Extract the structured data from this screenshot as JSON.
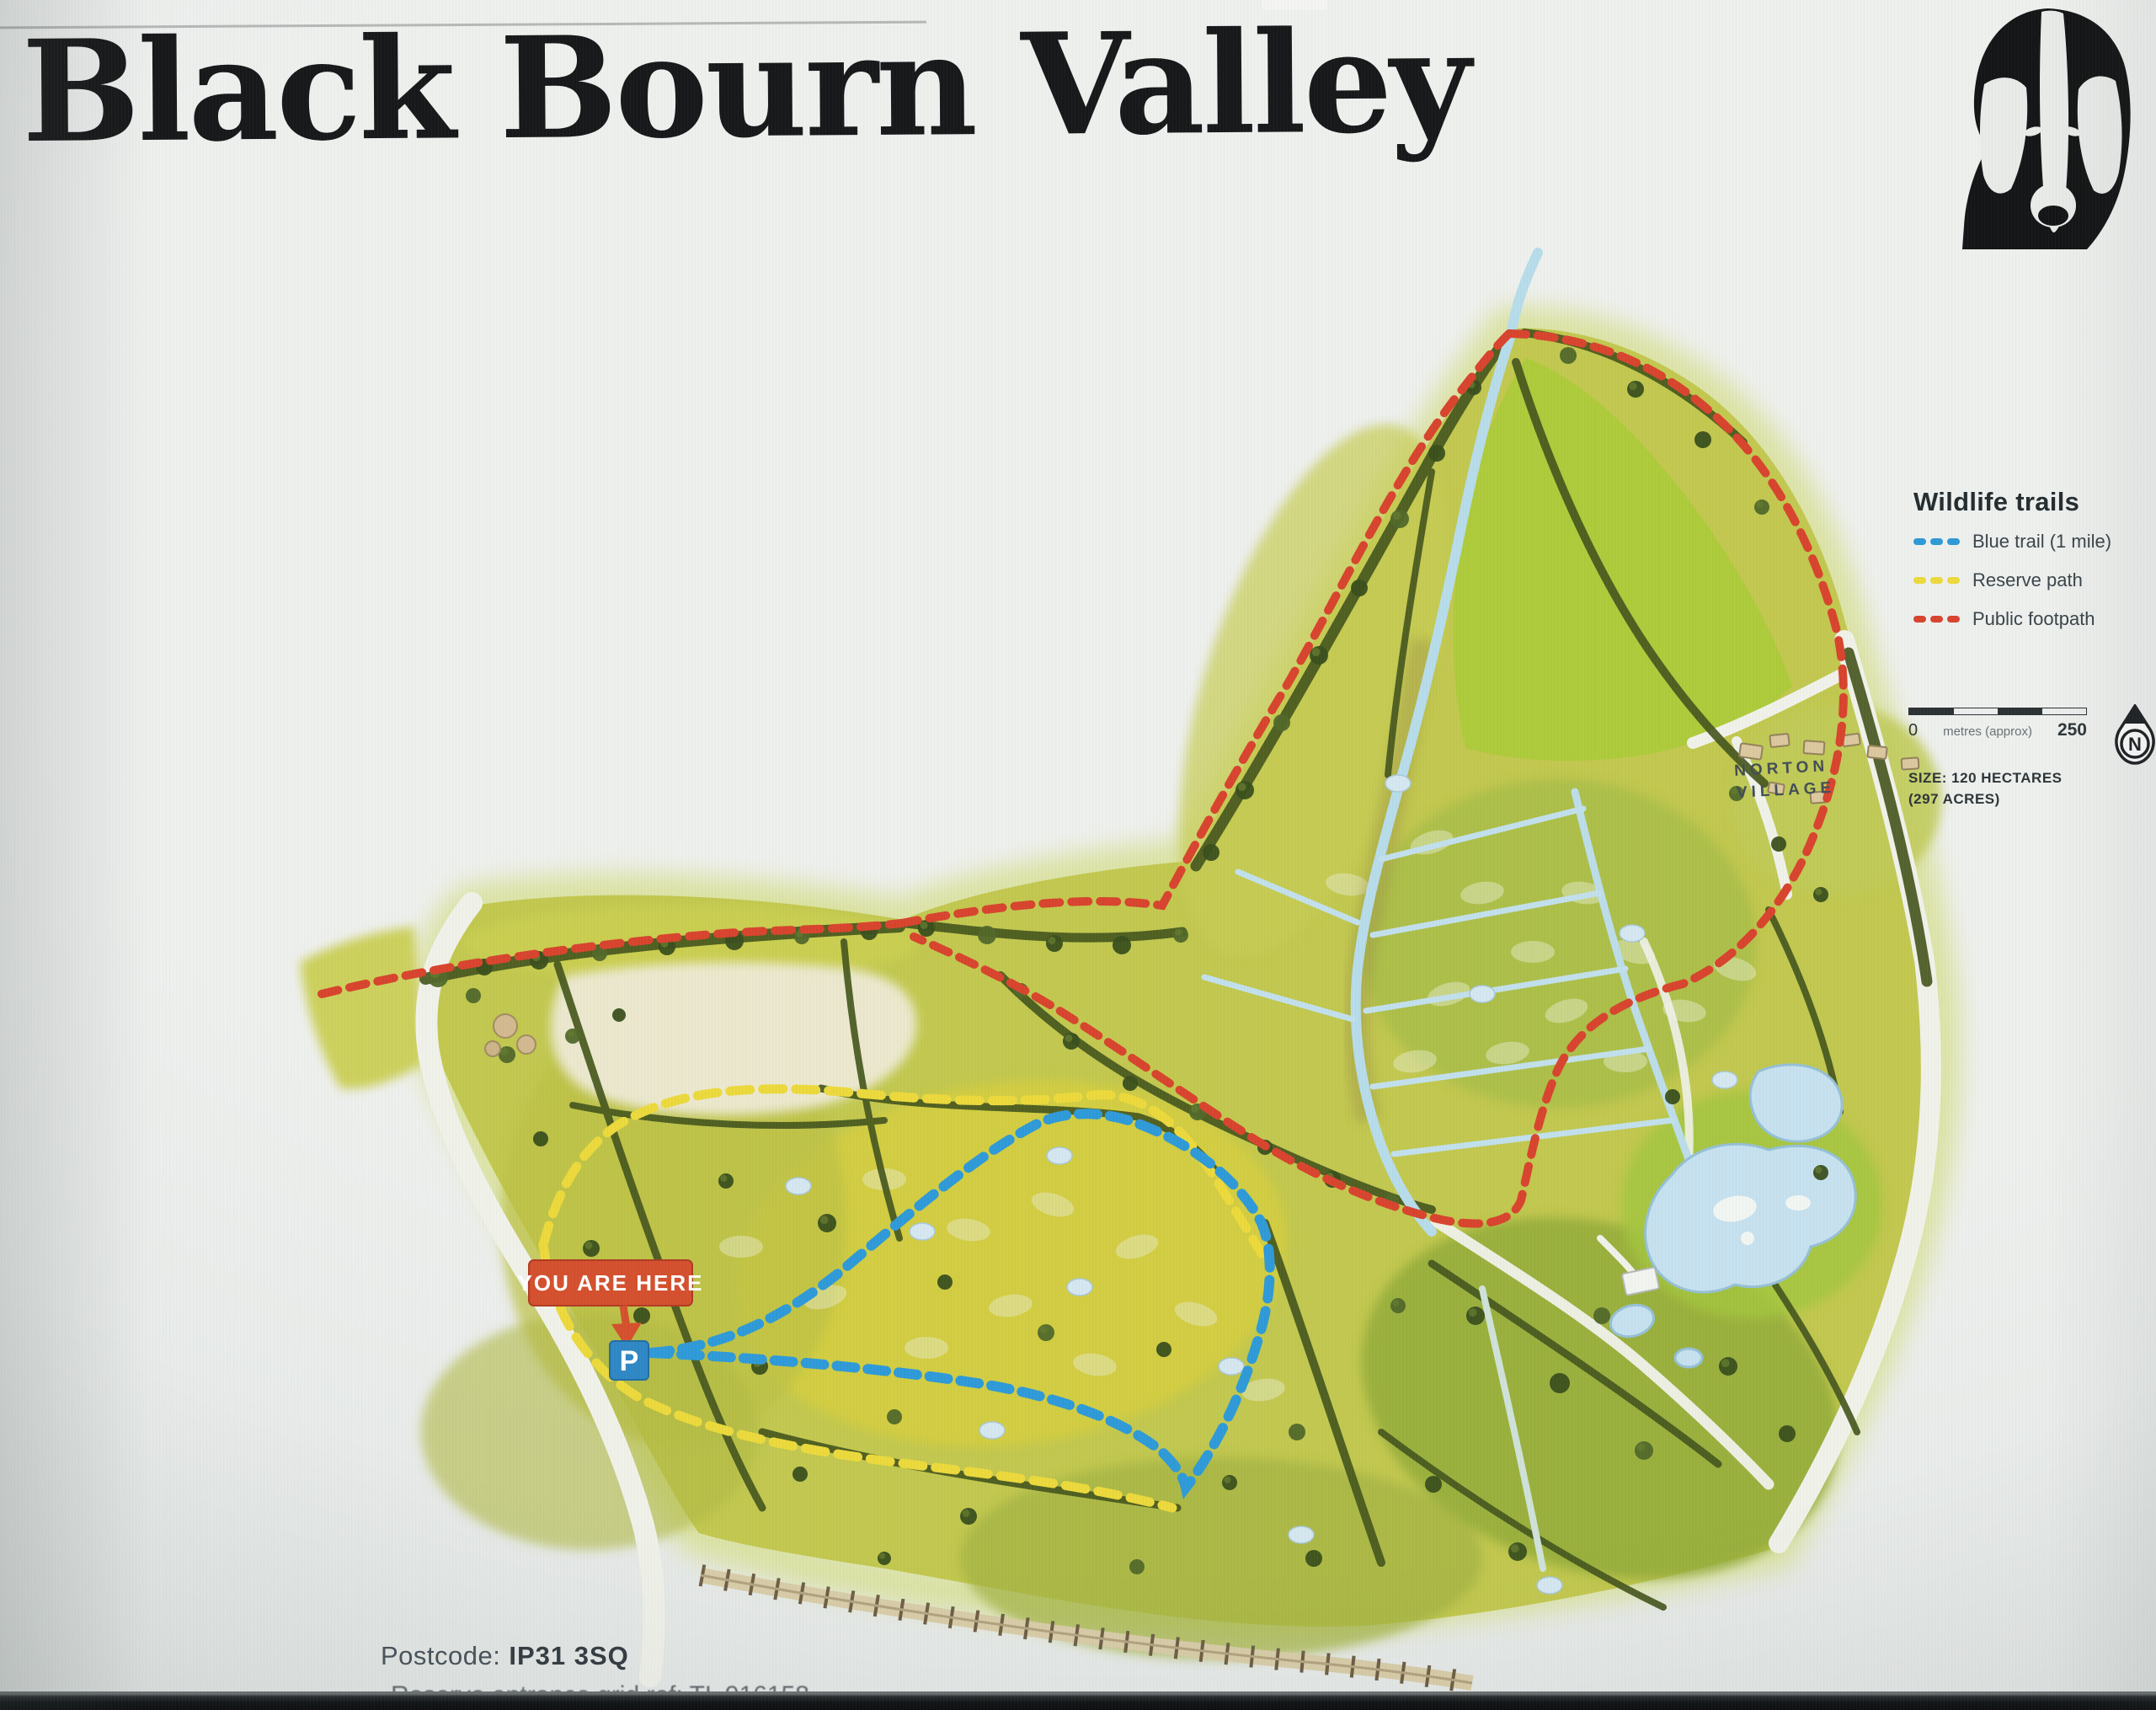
{
  "page": {
    "title": "Black Bourn Valley",
    "logo": "badger-icon"
  },
  "legend": {
    "title": "Wildlife trails",
    "items": [
      {
        "id": "blue-trail",
        "label": "Blue trail (1 mile)",
        "color": "#2e9ad6",
        "style": "dashed"
      },
      {
        "id": "reserve-path",
        "label": "Reserve path",
        "color": "#ecd93c",
        "style": "dashed"
      },
      {
        "id": "public-footpath",
        "label": "Public footpath",
        "color": "#d8442e",
        "style": "dashed"
      }
    ]
  },
  "scale_bar": {
    "start_label": "0",
    "unit_label": "metres (approx)",
    "end_label": "250"
  },
  "compass": {
    "label": "N"
  },
  "size_note": {
    "line1": "SIZE: 120 HECTARES",
    "line2": "(297 ACRES)"
  },
  "map_labels": {
    "village_line1": "NORTON",
    "village_line2": "VILLAGE",
    "you_are_here": "YOU ARE HERE",
    "parking": "P"
  },
  "footer": {
    "postcode_label": "Postcode:",
    "postcode_value": "IP31 3SQ",
    "clipped_line": "Reserve entrance grid ref: TL 916158"
  },
  "colors": {
    "trail_blue": "#2e9ad6",
    "trail_yellow": "#ecd93c",
    "trail_red": "#d8442e",
    "you_are_here_bg": "#d4502e",
    "parking_bg": "#2f88c5",
    "map_green": "#c2c84f",
    "water_blue": "#b7dcea"
  }
}
